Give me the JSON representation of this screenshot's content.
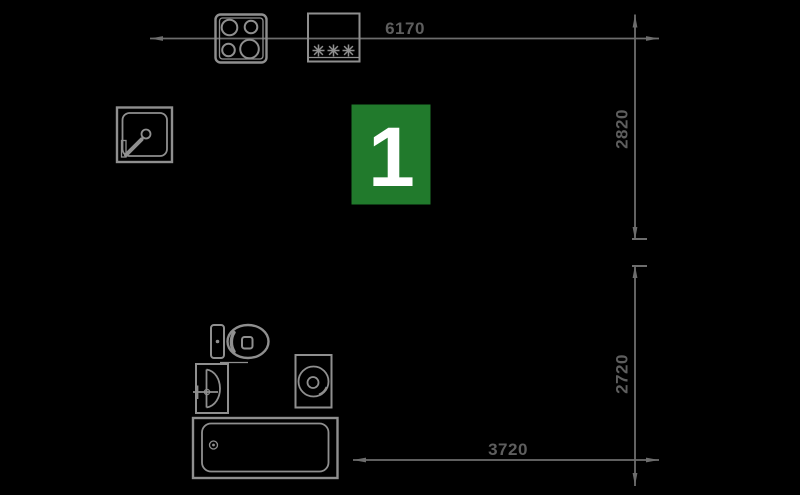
{
  "canvas": {
    "background": "#000000",
    "line_color": "#6d6d6d",
    "icon_color": "#8f8f8f",
    "dimension_text_color": "#5e5e5e"
  },
  "unit": {
    "number": "1",
    "badge_color": "#217a2c",
    "number_color": "#ffffff"
  },
  "dimensions": {
    "top": {
      "value": "6170",
      "orientation": "horizontal"
    },
    "right_upper": {
      "value": "2820",
      "orientation": "vertical"
    },
    "right_lower": {
      "value": "2720",
      "orientation": "vertical"
    },
    "bottom": {
      "value": "3720",
      "orientation": "horizontal"
    }
  },
  "icons": [
    {
      "name": "stove-icon",
      "shape": "square with 4 burner circles"
    },
    {
      "name": "asterisk-appliance-icon",
      "glyph": "✳✳✳"
    },
    {
      "name": "shower-icon",
      "shape": "square tray with drain and corner door"
    },
    {
      "name": "toilet-icon",
      "shape": "tank and oval bowl"
    },
    {
      "name": "washbasin-icon",
      "shape": "rectangle with D-bowl and tap"
    },
    {
      "name": "washing-machine-icon",
      "shape": "rectangle with drum circle"
    },
    {
      "name": "bathtub-icon",
      "shape": "rectangle with inner tub and drain"
    }
  ]
}
